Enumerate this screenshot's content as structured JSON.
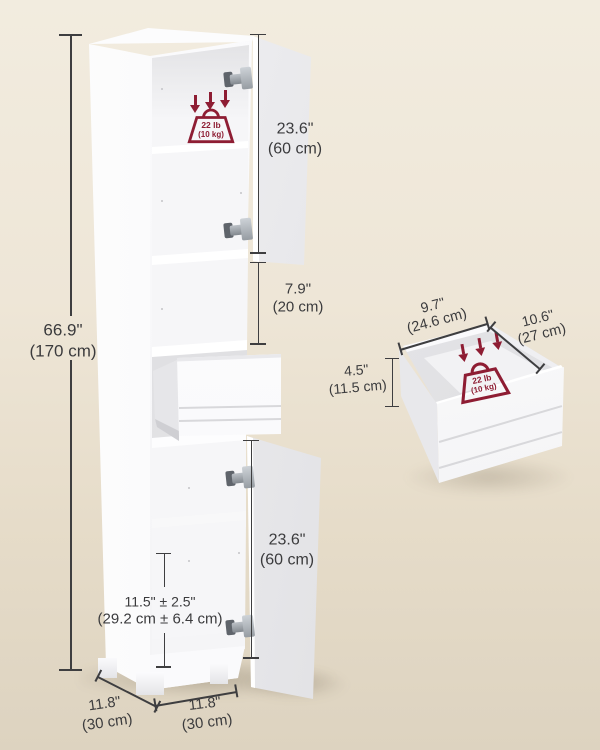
{
  "colors": {
    "background_top": "#F2ECDF",
    "background_bottom": "#DDD3C0",
    "dimension_line": "#3E3E40",
    "label_text": "#3B3B3D",
    "accent_red": "#8E1D33",
    "cabinet_white": "#FFFFFF"
  },
  "icons": {
    "load_arrows": "down-arrows-icon",
    "weight": "weight-capacity-icon",
    "hinge": "hinge-icon"
  },
  "cabinet": {
    "overall_height": {
      "inches": "66.9\"",
      "metric": "(170 cm)"
    },
    "upper_door_height": {
      "inches": "23.6\"",
      "metric": "(60 cm)"
    },
    "open_shelf_height": {
      "inches": "7.9\"",
      "metric": "(20 cm)"
    },
    "lower_door_height": {
      "inches": "23.6\"",
      "metric": "(60 cm)"
    },
    "adjustable_shelf_range": {
      "inches": "11.5\" ± 2.5\"",
      "metric": "(29.2 cm ± 6.4 cm)"
    },
    "depth": {
      "inches": "11.8\"",
      "metric": "(30 cm)"
    },
    "width": {
      "inches": "11.8\"",
      "metric": "(30 cm)"
    },
    "shelf_load": {
      "pounds": "22 lb",
      "metric": "(10 kg)"
    }
  },
  "drawer": {
    "width": {
      "inches": "9.7\"",
      "metric": "(24.6 cm)"
    },
    "depth": {
      "inches": "10.6\"",
      "metric": "(27 cm)"
    },
    "height": {
      "inches": "4.5\"",
      "metric": "(11.5 cm)"
    },
    "load": {
      "pounds": "22 lb",
      "metric": "(10 kg)"
    }
  }
}
